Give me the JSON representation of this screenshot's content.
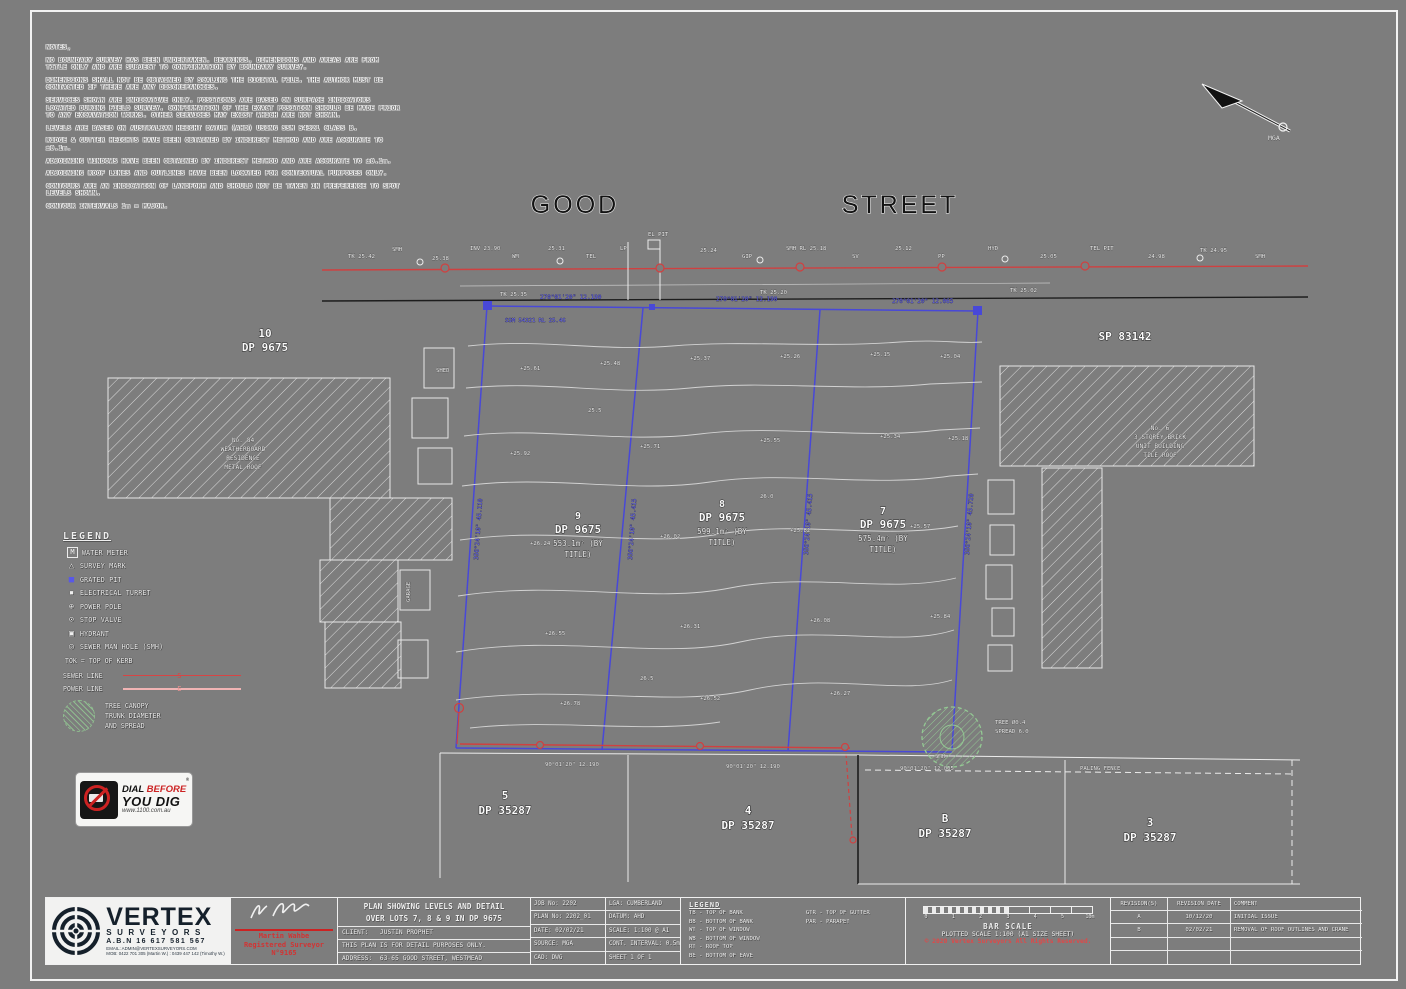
{
  "colors": {
    "background": "#7d7d7d",
    "boundary_blue": "#4848d8",
    "sewer_red": "#d04040",
    "power_pink": "#f0b4b4",
    "tree_green": "#93c893",
    "logo_navy": "#15202b",
    "copyright_red": "#e04848"
  },
  "notes": {
    "lines": [
      "NOTES,",
      "NO BOUNDARY SURVEY HAS BEEN UNDERTAKEN. BEARINGS, DIMENSIONS AND AREAS ARE FROM TITLE ONLY AND ARE SUBJECT TO CONFIRMATION BY BOUNDARY SURVEY.",
      "DIMENSIONS SHALL NOT BE OBTAINED BY SCALING THE DIGITAL FILE. THE AUTHOR MUST BE CONTACTED IF THERE ARE ANY DISCREPANCIES.",
      "SERVICES SHOWN ARE INDICATIVE ONLY. POSITIONS ARE BASED ON SURFACE INDICATORS LOCATED DURING FIELD SURVEY. CONFIRMATION OF THE EXACT POSITION SHOULD BE MADE PRIOR TO ANY EXCAVATION WORKS. OTHER SERVICES MAY EXIST WHICH ARE NOT SHOWN.",
      "LEVELS ARE BASED ON AUSTRALIAN HEIGHT DATUM (AHD) USING SSM 54321 CLASS B.",
      "RIDGE & GUTTER HEIGHTS HAVE BEEN OBTAINED BY INDIRECT METHOD AND ARE ACCURATE TO ±0.1m.",
      "ADJOINING WINDOWS HAVE BEEN OBTAINED BY INDIRECT METHOD AND ARE ACCURATE TO ±0.1m.",
      "ADJOINING ROOF LINES AND OUTLINES HAVE BEEN LOCATED FOR CONTEXTUAL PURPOSES ONLY.",
      "CONTOURS ARE AN INDICATION OF LANDFORM AND SHOULD NOT BE TAKEN IN PREFERENCE TO SPOT LEVELS SHOWN.",
      "CONTOUR INTERVALS 1m = MAJOR."
    ]
  },
  "street": {
    "word1": "GOOD",
    "word2": "STREET"
  },
  "north": {
    "label": "MGA"
  },
  "legend": {
    "title": "LEGEND",
    "items": [
      {
        "glyph": "M",
        "label": "WATER METER"
      },
      {
        "glyph": "△",
        "label": "SURVEY MARK"
      },
      {
        "glyph": "■",
        "label": "GRATED PIT"
      },
      {
        "glyph": "▪",
        "label": "ELECTRICAL TURRET"
      },
      {
        "glyph": "⊕",
        "label": "POWER POLE"
      },
      {
        "glyph": "⊙",
        "label": "STOP VALVE"
      },
      {
        "glyph": "▣",
        "label": "HYDRANT"
      },
      {
        "glyph": "◎",
        "label": "SEWER MAN HOLE (SMH)"
      }
    ],
    "note": "TOK = TOP OF KERB",
    "lines": [
      {
        "label": "SEWER LINE",
        "marker": "S"
      },
      {
        "label": "POWER LINE",
        "marker": "E"
      }
    ],
    "tree": {
      "line1": "TREE CANOPY",
      "line2": "TRUNK DIAMETER",
      "line3": "AND SPREAD"
    }
  },
  "dbyd": {
    "line1_a": "DIAL ",
    "line1_b": "BEFORE",
    "line2": "YOU DIG",
    "url": "www.1100.com.au",
    "reg": "®"
  },
  "plan": {
    "labels": {
      "lot9": {
        "num": "9",
        "dp": "DP 9675",
        "area1": "553.1m² (BY",
        "area2": "TITLE)"
      },
      "lot8": {
        "num": "8",
        "dp": "DP 9675",
        "area1": "599.1m² (BY",
        "area2": "TITLE)"
      },
      "lot7": {
        "num": "7",
        "dp": "DP 9675",
        "area1": "575.4m² (BY",
        "area2": "TITLE)"
      },
      "lot10": {
        "num": "10",
        "dp": "DP 9675"
      },
      "sp": "SP 83142",
      "b5": {
        "num": "5",
        "dp": "DP 35287"
      },
      "b4": {
        "num": "4",
        "dp": "DP 35287"
      },
      "bB": {
        "num": "B",
        "dp": "DP 35287"
      },
      "b3": {
        "num": "3",
        "dp": "DP 35287"
      },
      "nb_left": {
        "l1": "No. 84",
        "l2": "WEATHERBOARD",
        "l3": "RESIDENCE",
        "l4": "METAL ROOF"
      },
      "nb_right": {
        "l1": "No. 6",
        "l2": "3 STOREY BRICK",
        "l3": "UNIT BUILDING",
        "l4": "TILE ROOF"
      }
    },
    "annotations": [
      {
        "x": 348,
        "y": 258,
        "t": "TK 25.42",
        "c": "w"
      },
      {
        "x": 392,
        "y": 251,
        "t": "SMH",
        "c": "w"
      },
      {
        "x": 432,
        "y": 260,
        "t": "25.38",
        "c": "w"
      },
      {
        "x": 470,
        "y": 250,
        "t": "INV 23.90",
        "c": "w"
      },
      {
        "x": 512,
        "y": 258,
        "t": "WM",
        "c": "w"
      },
      {
        "x": 548,
        "y": 250,
        "t": "25.31",
        "c": "w"
      },
      {
        "x": 586,
        "y": 258,
        "t": "TEL",
        "c": "w"
      },
      {
        "x": 620,
        "y": 250,
        "t": "LP",
        "c": "w"
      },
      {
        "x": 648,
        "y": 236,
        "t": "EL PIT",
        "c": "w"
      },
      {
        "x": 700,
        "y": 252,
        "t": "25.24",
        "c": "w"
      },
      {
        "x": 742,
        "y": 258,
        "t": "GIP",
        "c": "w"
      },
      {
        "x": 786,
        "y": 250,
        "t": "SMH RL 25.18",
        "c": "w"
      },
      {
        "x": 852,
        "y": 258,
        "t": "SV",
        "c": "w"
      },
      {
        "x": 895,
        "y": 250,
        "t": "25.12",
        "c": "w"
      },
      {
        "x": 938,
        "y": 258,
        "t": "PP",
        "c": "w"
      },
      {
        "x": 988,
        "y": 250,
        "t": "HYD",
        "c": "w"
      },
      {
        "x": 1040,
        "y": 258,
        "t": "25.05",
        "c": "w"
      },
      {
        "x": 1090,
        "y": 250,
        "t": "TEL PIT",
        "c": "w"
      },
      {
        "x": 1148,
        "y": 258,
        "t": "24.98",
        "c": "w"
      },
      {
        "x": 1200,
        "y": 252,
        "t": "TK 24.95",
        "c": "w"
      },
      {
        "x": 1255,
        "y": 258,
        "t": "SMH",
        "c": "w"
      },
      {
        "x": 500,
        "y": 296,
        "t": "TK 25.35",
        "c": "w"
      },
      {
        "x": 760,
        "y": 294,
        "t": "TK 25.20",
        "c": "w"
      },
      {
        "x": 1010,
        "y": 292,
        "t": "TK 25.02",
        "c": "w"
      },
      {
        "x": 540,
        "y": 299,
        "t": "270°01'20\" 12.190",
        "c": "b",
        "s": 6
      },
      {
        "x": 716,
        "y": 301,
        "t": "270°01'20\" 12.190",
        "c": "b",
        "s": 6
      },
      {
        "x": 892,
        "y": 303,
        "t": "270°01'20\" 12.065",
        "c": "b",
        "s": 6
      },
      {
        "x": 505,
        "y": 322,
        "t": "SSM 54321 RL 25.46",
        "c": "b"
      },
      {
        "x": 478,
        "y": 560,
        "t": "356°24'10\" 45.110",
        "c": "b",
        "rot": -86,
        "s": 6
      },
      {
        "x": 632,
        "y": 560,
        "t": "356°24'10\" 45.415",
        "c": "b",
        "rot": -86,
        "s": 6
      },
      {
        "x": 808,
        "y": 555,
        "t": "356°24'10\" 45.415",
        "c": "b",
        "rot": -86,
        "s": 6
      },
      {
        "x": 969,
        "y": 555,
        "t": "356°24'10\" 45.720",
        "c": "b",
        "rot": -86,
        "s": 6
      },
      {
        "x": 545,
        "y": 766,
        "t": "90°01'20\" 12.190",
        "c": "w"
      },
      {
        "x": 726,
        "y": 768,
        "t": "90°01'20\" 12.190",
        "c": "w"
      },
      {
        "x": 900,
        "y": 770,
        "t": "90°01'20\" 12.065",
        "c": "w"
      },
      {
        "x": 520,
        "y": 370,
        "t": "+25.61",
        "c": "w"
      },
      {
        "x": 600,
        "y": 365,
        "t": "+25.48",
        "c": "w"
      },
      {
        "x": 690,
        "y": 360,
        "t": "+25.37",
        "c": "w"
      },
      {
        "x": 780,
        "y": 358,
        "t": "+25.26",
        "c": "w"
      },
      {
        "x": 870,
        "y": 356,
        "t": "+25.15",
        "c": "w"
      },
      {
        "x": 940,
        "y": 358,
        "t": "+25.04",
        "c": "w"
      },
      {
        "x": 510,
        "y": 455,
        "t": "+25.92",
        "c": "w"
      },
      {
        "x": 640,
        "y": 448,
        "t": "+25.71",
        "c": "w"
      },
      {
        "x": 760,
        "y": 442,
        "t": "+25.55",
        "c": "w"
      },
      {
        "x": 880,
        "y": 438,
        "t": "+25.34",
        "c": "w"
      },
      {
        "x": 948,
        "y": 440,
        "t": "+25.18",
        "c": "w"
      },
      {
        "x": 530,
        "y": 545,
        "t": "+26.24",
        "c": "w"
      },
      {
        "x": 660,
        "y": 538,
        "t": "+26.02",
        "c": "w"
      },
      {
        "x": 790,
        "y": 532,
        "t": "+25.82",
        "c": "w"
      },
      {
        "x": 910,
        "y": 528,
        "t": "+25.57",
        "c": "w"
      },
      {
        "x": 545,
        "y": 635,
        "t": "+26.55",
        "c": "w"
      },
      {
        "x": 680,
        "y": 628,
        "t": "+26.31",
        "c": "w"
      },
      {
        "x": 810,
        "y": 622,
        "t": "+26.08",
        "c": "w"
      },
      {
        "x": 930,
        "y": 618,
        "t": "+25.84",
        "c": "w"
      },
      {
        "x": 560,
        "y": 705,
        "t": "+26.78",
        "c": "w"
      },
      {
        "x": 700,
        "y": 700,
        "t": "+26.52",
        "c": "w"
      },
      {
        "x": 830,
        "y": 695,
        "t": "+26.27",
        "c": "w"
      },
      {
        "x": 588,
        "y": 412,
        "t": "25.5",
        "c": "w"
      },
      {
        "x": 760,
        "y": 498,
        "t": "26.0",
        "c": "w"
      },
      {
        "x": 640,
        "y": 680,
        "t": "26.5",
        "c": "w"
      },
      {
        "x": 995,
        "y": 724,
        "t": "TREE Ø0.4",
        "c": "w"
      },
      {
        "x": 995,
        "y": 733,
        "t": "SPREAD 6.0",
        "c": "w"
      },
      {
        "x": 935,
        "y": 758,
        "t": "SMH",
        "c": "w"
      },
      {
        "x": 1080,
        "y": 770,
        "t": "PALING FENCE",
        "c": "w"
      },
      {
        "x": 436,
        "y": 372,
        "t": "SHED",
        "c": "w"
      },
      {
        "x": 410,
        "y": 602,
        "t": "GARAGE",
        "c": "w",
        "rot": -90
      }
    ]
  },
  "title_block": {
    "logo": {
      "brand": "VERTEX",
      "sub": "SURVEYORS",
      "abn": "A.B.N 16 617 581 567",
      "contact1": "EMAIL: ADMIN@VERTEXSURVEYORS.COM",
      "contact2": "MOB: 0422 701 305 (Martin W.) : 0439 447 142 (Timothy W.)"
    },
    "surveyor": {
      "name": "Martin Wahbe",
      "role": "Registered Surveyor",
      "number": "N°9165"
    },
    "title1": "PLAN SHOWING LEVELS AND DETAIL",
    "title2": "OVER LOTS 7, 8 & 9 IN DP 9675",
    "rows": {
      "client": "CLIENT:   JUSTIN PROPHET",
      "purpose": "THIS PLAN IS FOR DETAIL PURPOSES ONLY.",
      "address": "ADDRESS:  63-65 GOOD STREET, WESTMEAD"
    },
    "col1": [
      "JOB No: 2202",
      "PLAN No: 2202_01",
      "DATE: 02/02/21",
      "SOURCE: MGA",
      "CAD: DWG"
    ],
    "col2": [
      "LGA: CUMBERLAND",
      "DATUM: AHD",
      "SCALE: 1:100 @ A1",
      "CONT. INTERVAL: 0.5m",
      "SHEET 1 OF 1"
    ],
    "abbrev": {
      "title": "LEGEND",
      "left": [
        "TB - TOP OF BANK",
        "BB - BOTTOM OF BANK",
        "WT - TOP OF WINDOW",
        "WB - BOTTOM OF WINDOW",
        "RT - ROOF TOP",
        "BE - BOTTOM OF EAVE"
      ],
      "right": [
        "GTR - TOP OF GUTTER",
        "PAR - PARAPET"
      ]
    },
    "bar": {
      "caption": "BAR SCALE",
      "plotted": "PLOTTED SCALE 1:100 (A1 SIZE SHEET)",
      "copyright": "© 2020 Vertex Surveyors All Rights Reserved.",
      "ticks": [
        "0",
        "1",
        "2",
        "3",
        "4",
        "5",
        "10m"
      ]
    },
    "revisions": {
      "h": [
        "REVISION(S)",
        "REVISION DATE",
        "COMMENT"
      ],
      "rows": [
        [
          "A",
          "10/12/20",
          "INITIAL ISSUE"
        ],
        [
          "B",
          "02/02/21",
          "REMOVAL OF ROOF OUTLINES AND CRANE"
        ],
        [
          "",
          "",
          ""
        ],
        [
          "",
          "",
          ""
        ]
      ]
    }
  }
}
